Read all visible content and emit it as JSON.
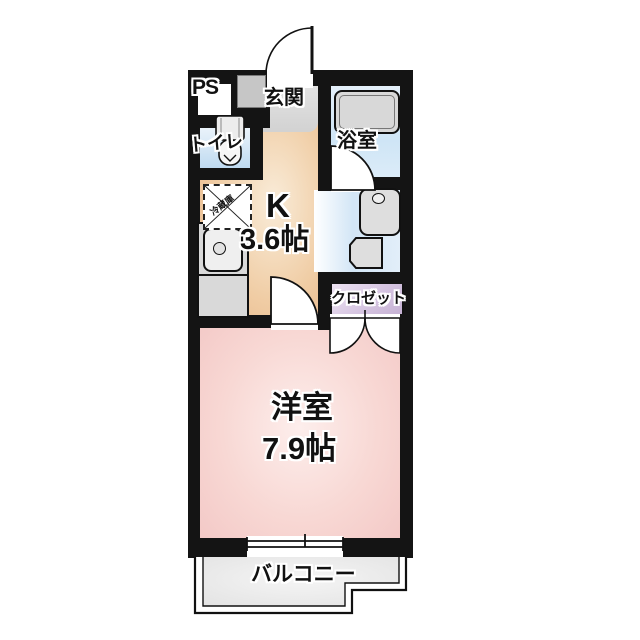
{
  "floorplan": {
    "rooms": {
      "ps": {
        "label": "PS"
      },
      "entrance": {
        "label": "玄関"
      },
      "bathroom": {
        "label": "浴室"
      },
      "toilet": {
        "label": "トイレ"
      },
      "kitchen": {
        "label": "K",
        "size": "3.6帖"
      },
      "closet": {
        "label": "クロゼット"
      },
      "western_room": {
        "label": "洋室",
        "size": "7.9帖"
      },
      "balcony": {
        "label": "バルコニー"
      }
    },
    "annotations": {
      "refrigerator": "冷蔵庫"
    },
    "colors": {
      "wall": "#141414",
      "kitchen_floor": "#f0cda5",
      "western_room_floor": "#f8d8d4",
      "water_area_floor": "#cfe5f6",
      "closet_fill": "#d6c5e1",
      "entrance_floor": "#d8d8d8",
      "balcony_floor": "#ededed"
    }
  }
}
